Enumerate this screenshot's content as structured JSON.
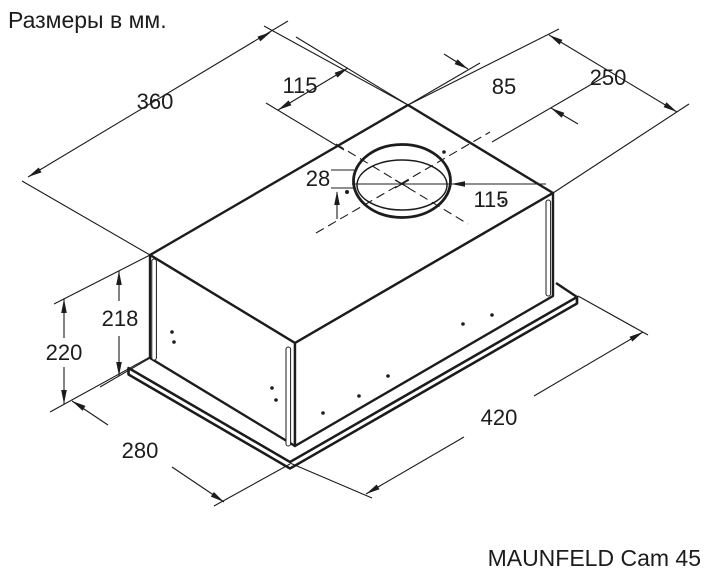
{
  "meta": {
    "units_note": "Размеры в мм.",
    "product": "MAUNFELD Cam 45"
  },
  "dimensions": {
    "top_width": "360",
    "vent_offset_left": "115",
    "vent_offset_right": "85",
    "top_depth": "250",
    "collar_height": "28",
    "vent_diameter": "115",
    "body_height": "218",
    "overall_height": "220",
    "base_depth": "280",
    "base_width": "420"
  },
  "colors": {
    "line": "#1c1c1c",
    "background": "#ffffff"
  }
}
